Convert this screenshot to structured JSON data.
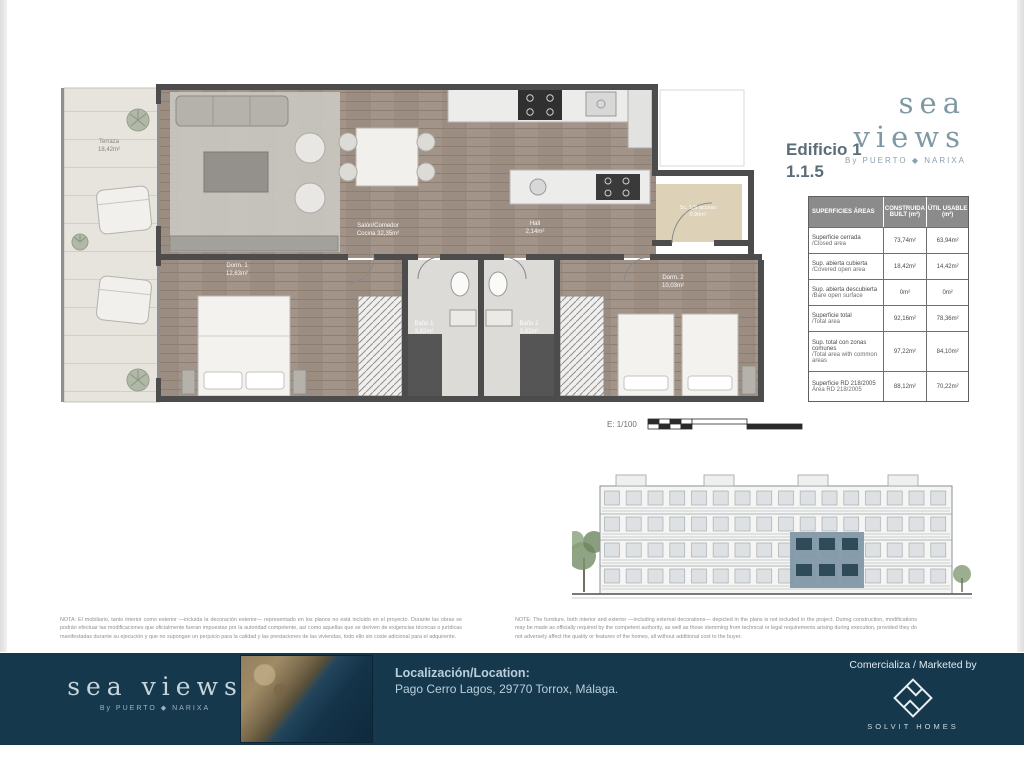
{
  "header": {
    "brand": "sea views",
    "byline": "By PUERTO ◆ NARIXA",
    "building": "Edificio 1",
    "unit": "1.1.5"
  },
  "areas_table": {
    "col_area": "SUPERFICIES ÁREAS",
    "col_built": "CONSTRUIDA BUILT (m²)",
    "col_usable": "ÚTIL USABLE (m²)",
    "rows": [
      {
        "label_es": "Superficie cerrada",
        "label_en": "/Closed area",
        "built": "73,74m²",
        "usable": "63,94m²"
      },
      {
        "label_es": "Sup. abierta cubierta",
        "label_en": "/Covered open area",
        "built": "18,42m²",
        "usable": "14,42m²"
      },
      {
        "label_es": "Sup. abierta descubierta",
        "label_en": "/Bare open surface",
        "built": "0m²",
        "usable": "0m²"
      },
      {
        "label_es": "Superficie total",
        "label_en": "/Total area",
        "built": "92,16m²",
        "usable": "78,36m²"
      },
      {
        "label_es": "Sup. total con zonas comunes",
        "label_en": "/Total area with common areas",
        "built": "97,22m²",
        "usable": "84,10m²"
      },
      {
        "label_es": "Superficie RD 218/2005",
        "label_en": "Área RD 218/2005",
        "built": "88,12m²",
        "usable": "70,22m²"
      }
    ]
  },
  "floorplan": {
    "scale": "E: 1/100",
    "rooms": [
      {
        "name": "Terraza",
        "area": "18,42m²"
      },
      {
        "name": "Salón/Comedor",
        "area": "Cocina  32,35m²"
      },
      {
        "name": "Hall",
        "area": "2,14m²"
      },
      {
        "name": "Sc. 1/S acceso",
        "area": "0,90m²"
      },
      {
        "name": "Dorm. 1",
        "area": "12,63m²"
      },
      {
        "name": "Dorm. 2",
        "area": "10,03m²"
      },
      {
        "name": "Baño 1",
        "area": "3,82m²"
      },
      {
        "name": "Baño 2",
        "area": "3,82m²"
      }
    ]
  },
  "notes": {
    "es": "NOTA: El mobiliario, tanto interior como exterior —incluida la decoración exterior— representado en los planos no está incluido en el proyecto. Durante las obras se podrán efectuar las modificaciones que oficialmente fueran impuestas por la autoridad competente, así como aquellas que se deriven de exigencias técnicas o jurídicas manifestadas durante su ejecución y que no supongan un perjuicio para la calidad y las prestaciones de las viviendas, todo ello sin coste adicional para el adquirente.",
    "en": "NOTE: The furniture, both interior and exterior —including external decorations— depicted in the plans is not included in the project. During construction, modifications may be made as officially required by the competent authority, as well as those stemming from technical or legal requirements arising during execution, provided they do not adversely affect the quality or features of the homes, all without additional cost to the buyer."
  },
  "footer": {
    "brand": "sea views",
    "byline": "By PUERTO ◆ NARIXA",
    "location_label": "Localización/Location:",
    "location_value": "Pago Cerro Lagos, 29770 Torrox, Málaga.",
    "marketed_label": "Comercializa / Marketed by",
    "marketed_name": "SOLVIT HOMES"
  }
}
